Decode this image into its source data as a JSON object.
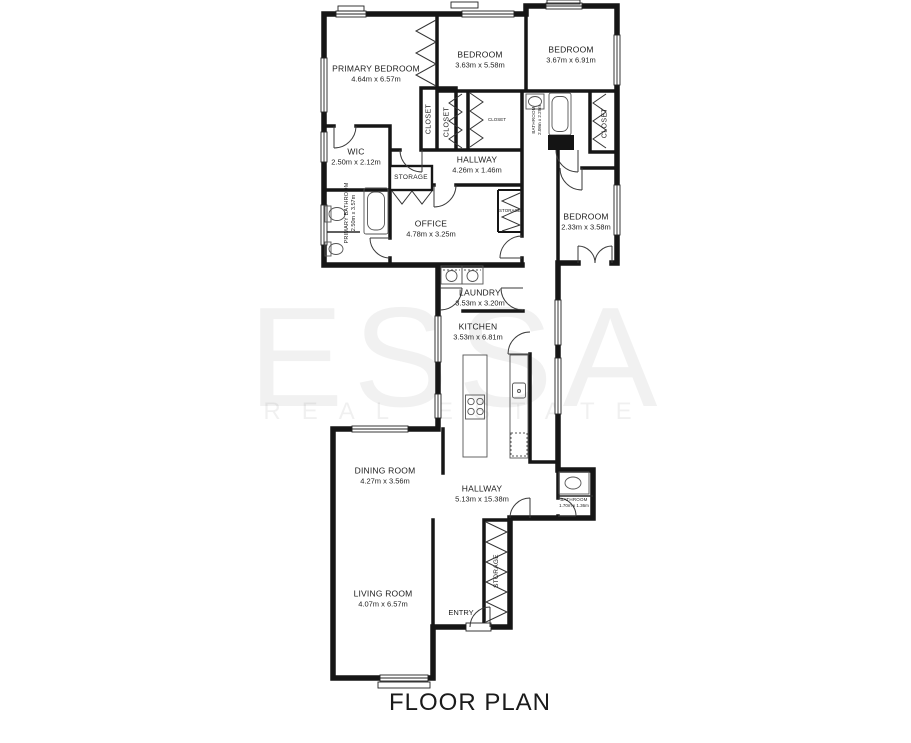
{
  "title": "FLOOR PLAN",
  "watermark": {
    "line1": "ESSA",
    "line2": "REAL ESTATE"
  },
  "rooms": [
    {
      "name": "PRIMARY BEDROOM",
      "dims": "4.64m x 6.57m"
    },
    {
      "name": "BEDROOM",
      "dims": "3.63m x 5.58m"
    },
    {
      "name": "BEDROOM",
      "dims": "3.67m x 6.91m"
    },
    {
      "name": "WIC",
      "dims": "2.50m x 2.12m"
    },
    {
      "name": "HALLWAY",
      "dims": "4.26m x 1.46m"
    },
    {
      "name": "OFFICE",
      "dims": "4.78m x 3.25m"
    },
    {
      "name": "BEDROOM",
      "dims": "2.33m x 3.58m"
    },
    {
      "name": "LAUNDRY",
      "dims": "3.53m x 3.20m"
    },
    {
      "name": "KITCHEN",
      "dims": "3.53m x 6.81m"
    },
    {
      "name": "DINING ROOM",
      "dims": "4.27m x 3.56m"
    },
    {
      "name": "HALLWAY",
      "dims": "5.13m x 15.38m"
    },
    {
      "name": "LIVING ROOM",
      "dims": "4.07m x 6.57m"
    },
    {
      "name": "PRIMARY BATHROOM",
      "dims": "2.50m x 3.57m"
    },
    {
      "name": "BATHROOM",
      "dims": "2.08m x 2.29m"
    },
    {
      "name": "BATHROOM",
      "dims": "1.70m x 1.36m"
    },
    {
      "name": "ENTRY",
      "dims": ""
    }
  ],
  "misc": {
    "closet": "CLOSET",
    "storage": "STORAGE"
  }
}
